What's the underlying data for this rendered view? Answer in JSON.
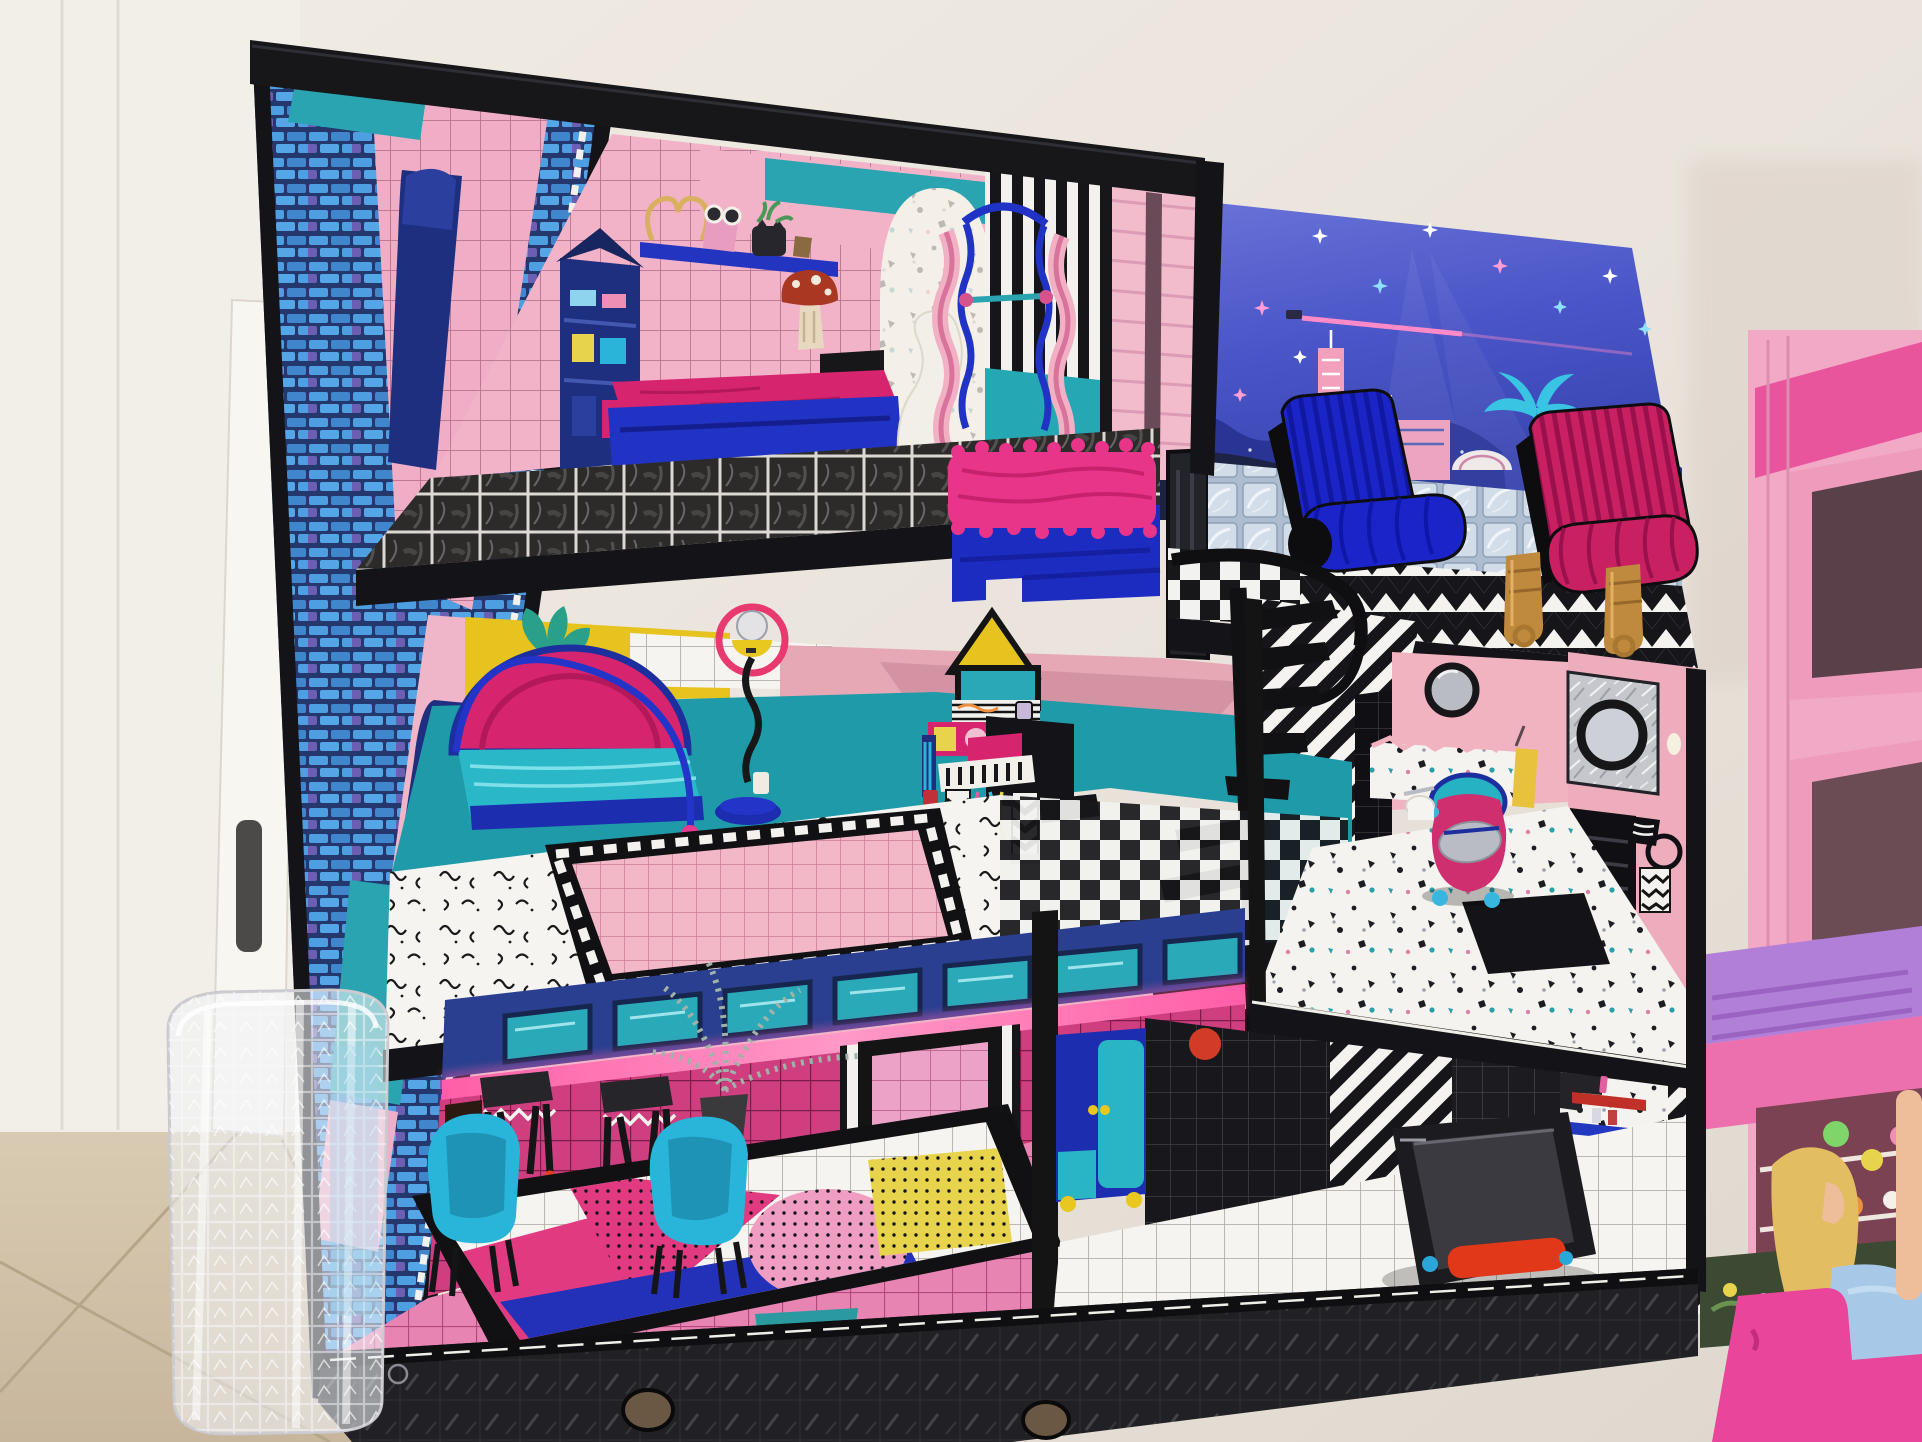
{
  "scene": {
    "title": "Toy dollhouse photo",
    "description": "A three-storey LOL Surprise OMG dollhouse with black frame stands against a white wall on a beige tile floor. A white door, a leaning white board and a clear plastic waste basket are on the left; a pink Barbie dollhouse with a blonde doll sits on the right.",
    "environment": {
      "wall": {
        "label": "white wall",
        "color": "#eae5de"
      },
      "tile_floor": {
        "label": "beige tile floor with diagonal grout lines",
        "color": "#d2c3ab"
      },
      "door": {
        "label": "white door",
        "color": "#f3f0ea"
      },
      "door_handle": {
        "label": "dark door handle"
      },
      "leaning_board": {
        "label": "white board leaning against the door"
      },
      "waste_basket": {
        "label": "clear textured plastic waste basket"
      }
    },
    "dollhouse": {
      "label": "LOL Surprise OMG three-storey dollhouse",
      "frame_color": "#17171a",
      "side_wall": {
        "label": "printed side wall with blue bricks, pink tiles, teal bands and arch decal"
      },
      "top_floor": {
        "label": "top-floor bedroom",
        "objects": [
          "pink grid tile walls with teal band",
          "wall shelf with heart wire, pink purse, sunglasses, black cat planter",
          "mushroom wall decal",
          "painted wardrobe decal",
          "black staircase",
          "royal blue bed with magenta mattress",
          "white chaise with orange-red base",
          "pink wavy loft ladder with blue rails",
          "blue bed with hot-pink fur blanket",
          "striped partition with pink door panel",
          "black marble grid floor"
        ]
      },
      "rooftop_terrace": {
        "label": "rooftop terrace",
        "objects": [
          "glass block railing",
          "checkerboard and black-white chevron deck",
          "royal blue ribbed lounge chair",
          "magenta ribbed lounge chair",
          "two gold doll boots",
          "dark mirror panel"
        ]
      },
      "middle_floor": {
        "label": "middle-floor bedroom and music corner",
        "objects": [
          "yellow wall with plant mural",
          "white tile patch",
          "rose pink wall",
          "teal lower wall",
          "teal bed with magenta dome canopy and navy arch",
          "floor lamp with pink ring, yellow shade and zigzag stem",
          "triangle-top vanity mirror decal",
          "black toy piano with chevron striped legs and colorful cords",
          "white squiggle floor with pink grid rug",
          "black spiral staircase with curved rail",
          "diagonal striped stair wall"
        ]
      },
      "bathroom": {
        "label": "bathroom",
        "objects": [
          "pink walls",
          "porthole mirror",
          "foil panel with round black mirror",
          "yellow hand towel",
          "painted black vanity",
          "towel ring with black-and-white towel",
          "zigzag art card",
          "terrazzo half wall and floor",
          "magenta and teal potty with silver lid and blue feet",
          "toilet paper roll",
          "black bath mat"
        ]
      },
      "ground_floor_left": {
        "label": "ground-floor lounge",
        "objects": [
          "navy band with teal windows",
          "pink neon light bar",
          "magenta grid tile wall",
          "black framed window",
          "flame decal",
          "silver palm plant in pot",
          "two black stools with white zigzag aprons and red feet",
          "two cyan shell chairs with black legs",
          "white grid rug with magenta, blue, pink and yellow geometric shapes",
          "pink grid tile floor"
        ]
      },
      "ground_floor_right": {
        "label": "ground-floor gym and closet",
        "objects": [
          "royal blue cabinet with teal door and yellow feet",
          "black grid wall with red dot",
          "diagonal striped walls",
          "terrazzo panel with red and blue mini shelves and tiny toys",
          "green plant decal",
          "black treadmill with red handle and blue knobs",
          "white grid floor"
        ]
      },
      "base": {
        "label": "black textured base with finger holes"
      }
    },
    "backdrop": {
      "label": "night city skyline backdrop board",
      "elements": [
        "starry purple-blue sky",
        "white, pink and cyan sparkles",
        "pink searchlight beam with glider",
        "pink clouds",
        "navy mountains dotted with lights",
        "pink and blue skyscrapers",
        "white dome arena",
        "cyan palm trees",
        "dark road with light trails"
      ]
    },
    "barbie_house": {
      "label": "pink Barbie dollhouse",
      "objects": [
        "dark pink roof bar",
        "two window openings",
        "violet ridged roof piece",
        "pink fascia",
        "shelf nook with colorful toys",
        "window flower box",
        "blonde doll in light blue dress",
        "hot pink step sofa"
      ]
    }
  },
  "palette": {
    "royal_blue": "#1f2ac6",
    "magenta": "#d6246e",
    "hot_pink_fur": "#e8358a",
    "teal": "#1f9fa8",
    "cyan_chair": "#2ab4d9",
    "pink_wall": "#f0abc2",
    "rose_wall": "#e2a2b0",
    "yellow": "#e4c022",
    "navy": "#1d2f8e",
    "barbie_pink": "#f2a9c5",
    "violet_roof": "#b27fd8",
    "sky_blue": "#4d58c6",
    "gold": "#c3913f",
    "black_frame": "#17171a",
    "wall_white": "#eae5de",
    "floor_beige": "#d2c3ab"
  }
}
